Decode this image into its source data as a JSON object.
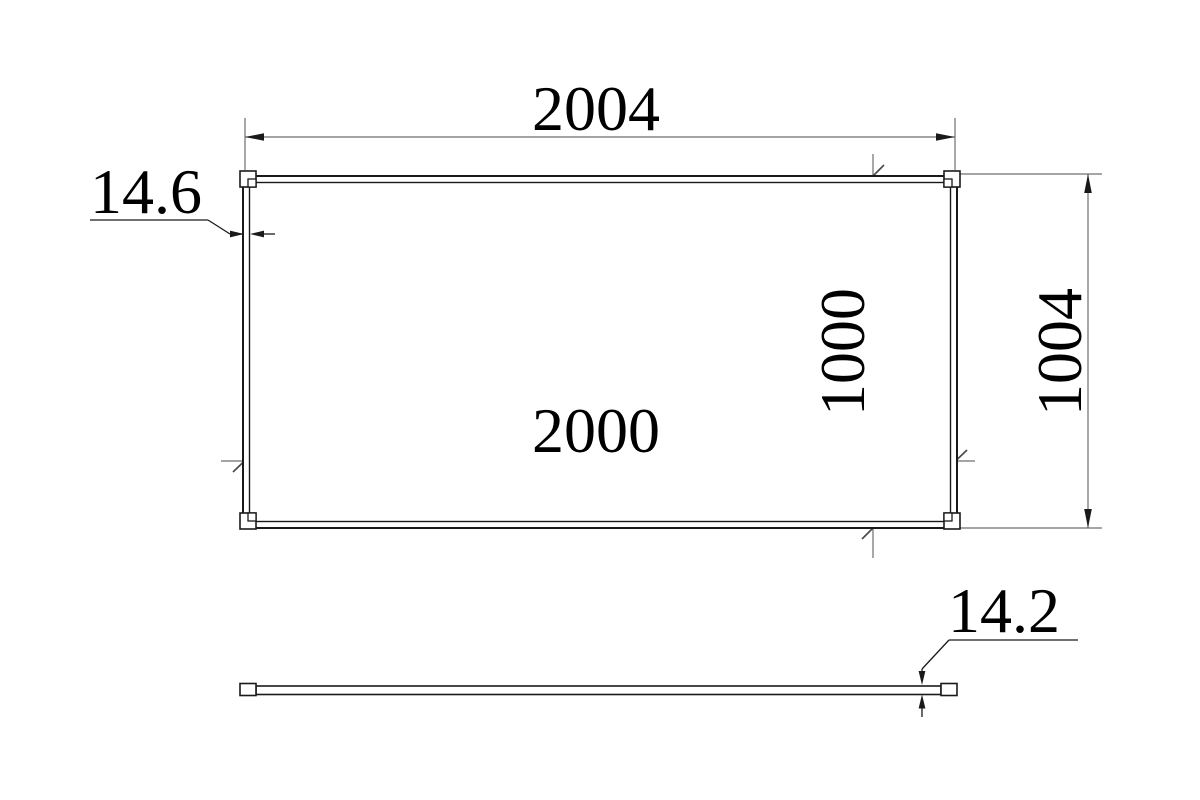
{
  "drawing": {
    "type": "panel-dimension-drawing",
    "views": {
      "front": {
        "overall_width": "2004",
        "inner_width": "2000",
        "overall_height": "1004",
        "inner_height": "1000",
        "frame_thickness": "14.6"
      },
      "side": {
        "panel_thickness": "14.2"
      }
    },
    "colors": {
      "background": "#ffffff",
      "object_line": "#1a1a1a",
      "dimension_line": "#6f6f6f",
      "tick_line": "#4a4a4a",
      "leader_line": "#1a1a1a",
      "text": "#000000"
    }
  }
}
